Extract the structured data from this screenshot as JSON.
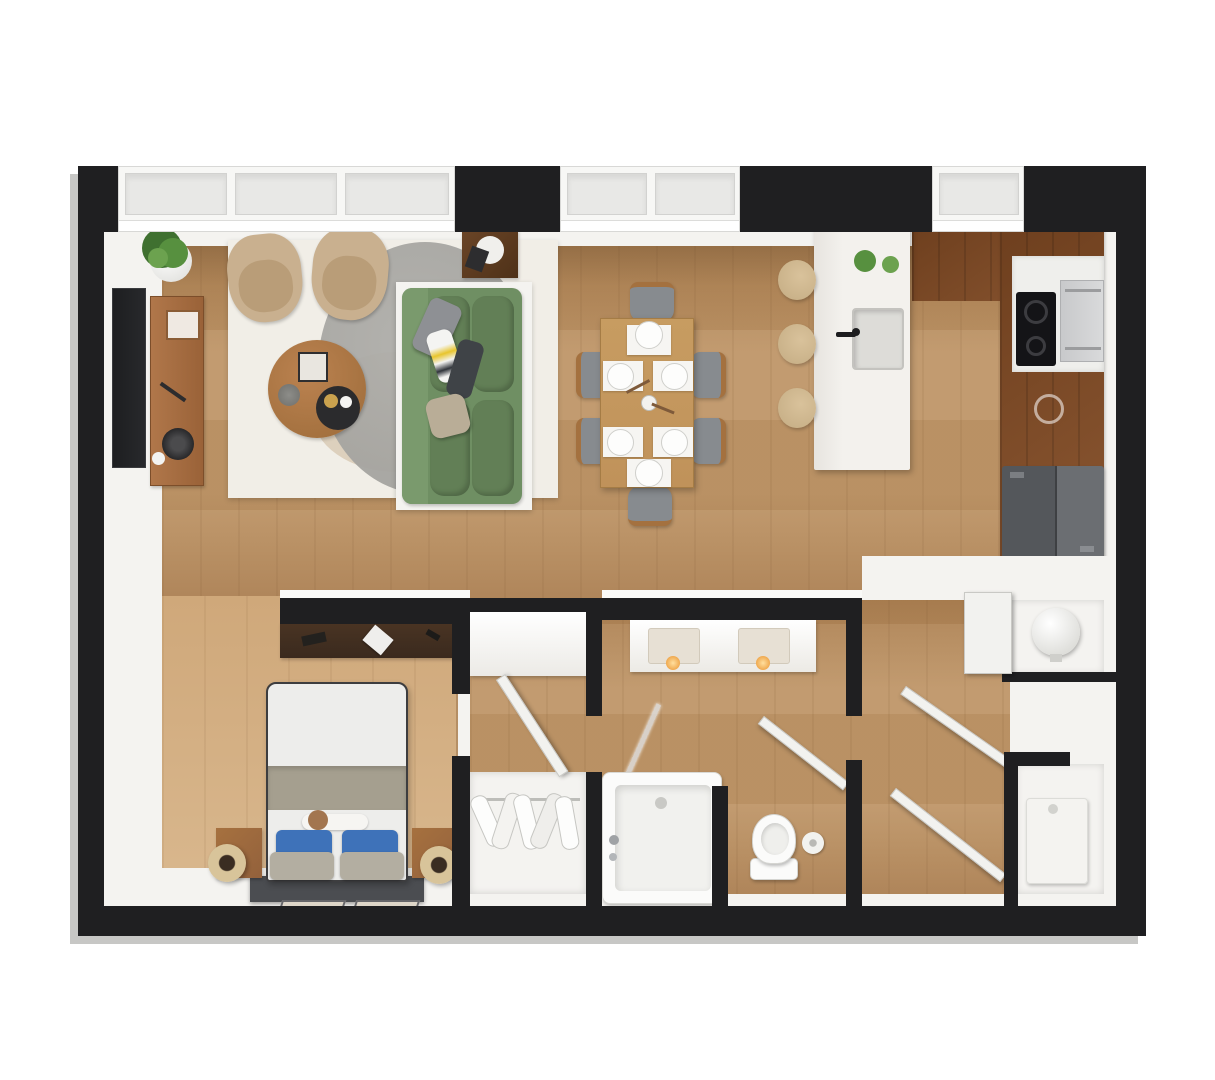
{
  "scene": {
    "kind": "3d-top-down-apartment-floor-plan",
    "rooms": [
      {
        "id": "living-room",
        "contents": [
          "wall-tv",
          "tv-console",
          "potted-plant",
          "armchair",
          "armchair",
          "round-coffee-table",
          "area-rug-white",
          "area-rug-gray-round",
          "sofa-green",
          "side-table"
        ]
      },
      {
        "id": "dining-area",
        "contents": [
          "dining-table",
          "dining-chair-x6",
          "place-setting-x6",
          "centerpiece"
        ]
      },
      {
        "id": "kitchen",
        "contents": [
          "island-with-sink",
          "bar-stool-x3",
          "small-plant-x2",
          "upper-cabinets",
          "cooktop",
          "oven",
          "counter-sink",
          "refrigerator"
        ]
      },
      {
        "id": "bedroom",
        "contents": [
          "desk",
          "double-bed",
          "pillow-blue-x2",
          "pillow-gray-x2",
          "nightstand-x2",
          "floor-mat-x2",
          "wood-floor-panel"
        ]
      },
      {
        "id": "walk-in-closet",
        "contents": [
          "entry-cabinet",
          "hanging-clothes"
        ]
      },
      {
        "id": "bathroom",
        "contents": [
          "double-vanity",
          "vanity-light-x2",
          "bathtub",
          "shower-glass",
          "toilet",
          "paper-roll"
        ]
      },
      {
        "id": "utility",
        "contents": [
          "water-heater",
          "washer",
          "open-door-x3"
        ]
      }
    ],
    "counts": {
      "windows": 3,
      "armchairs": 2,
      "dining_chairs": 6,
      "bar_stools": 3,
      "doors_open": 4
    }
  },
  "palette": {
    "bg": "#ffffff",
    "wall": "#1f1f21",
    "wallCap": "#fafaf8",
    "shadow": "#c7c7c5",
    "winFrame": "#f7f7f5",
    "winPane": "#e8e8e6",
    "floorWhite": "#f4f3f0",
    "wood": "#bf9668",
    "woodDark": "#ab7f51",
    "woodBed": "#cfa87a",
    "woodBedLight": "#d8b68c",
    "counterWood": "#8a5631",
    "counterWoodDark": "#6e3f1e",
    "rugWhite": "#f1eee7",
    "rugGray": "#a5a4a0",
    "rugBeige": "#ddd0bd",
    "sofaGreen": "#6f8f63",
    "sofaGreenDark": "#627f56",
    "armchairBeige": "#c9b08f",
    "armchairSeat": "#b99d78",
    "stoolBeige": "#d9c29b",
    "tableWood": "#c0925a",
    "chairGray": "#878b8f",
    "chairWood": "#a4713f",
    "tvDark": "#28292c",
    "consoleWood": "#b0774a",
    "duvetWhite": "#ededeb",
    "duvetBand": "#a59f8f",
    "pillowBlue": "#3e72b9",
    "pillowGray": "#b3aea1",
    "headboardDark": "#4b4d51",
    "nightstandWood": "#93613c",
    "deskDark": "#3a2a1e",
    "fridgeGray": "#54575b",
    "fridgeGrayLight": "#6b6e72",
    "cooktopBlack": "#141417",
    "ovenSilver": "#d9dadb",
    "fixtureWhite": "#fbfbfa",
    "matBeige": "#ded6c9",
    "plantGreen": "#57903f",
    "plantGreenDark": "#3f7030",
    "doorWhite": "#f2f2ef",
    "islandWhite": "#f3f1ed"
  }
}
